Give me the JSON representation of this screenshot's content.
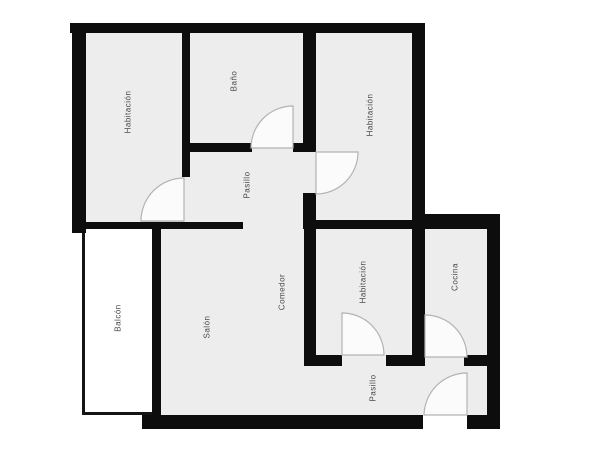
{
  "floorplan": {
    "type": "apartment-floor-plan",
    "rooms": [
      {
        "id": "habitacion-top-left",
        "label": "Habitación"
      },
      {
        "id": "bano",
        "label": "Baño"
      },
      {
        "id": "habitacion-top-right",
        "label": "Habitación"
      },
      {
        "id": "pasillo-upper",
        "label": "Pasillo"
      },
      {
        "id": "comedor",
        "label": "Comedor"
      },
      {
        "id": "salon",
        "label": "Salón"
      },
      {
        "id": "habitacion-bottom",
        "label": "Habitación"
      },
      {
        "id": "cocina",
        "label": "Cocina"
      },
      {
        "id": "balcon",
        "label": "Balcón"
      },
      {
        "id": "pasillo-lower",
        "label": "Pasillo"
      }
    ],
    "door_count": 6,
    "colors": {
      "wall": "#0d0d0d",
      "floor": "#ededed",
      "balcony_fill": "#ffffff",
      "door_arc": "#b3b3b3",
      "label_text": "#4a4a4a",
      "background": "#ffffff"
    }
  }
}
